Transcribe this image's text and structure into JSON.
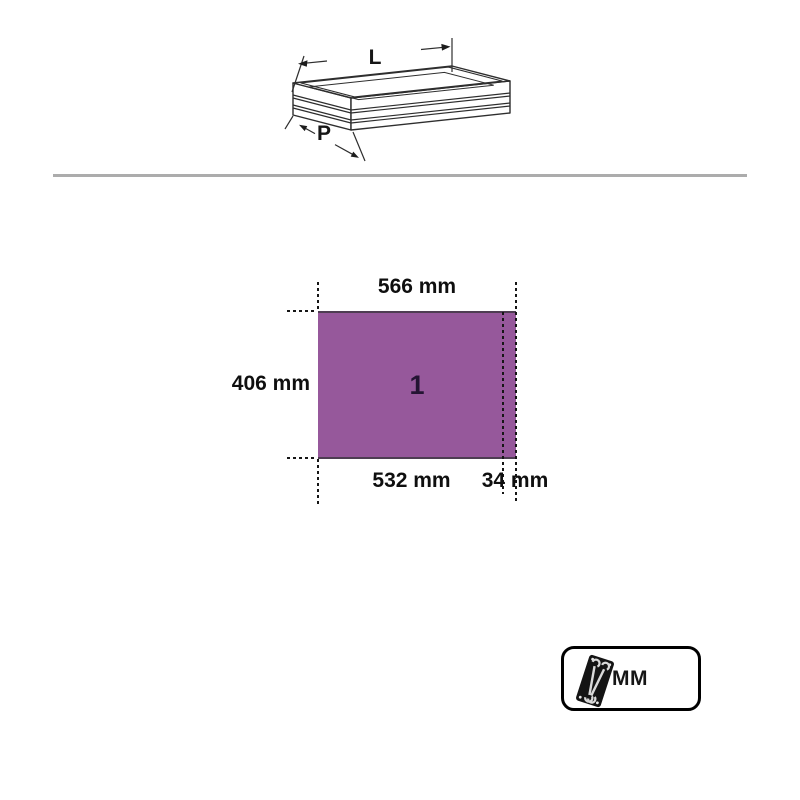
{
  "figure": {
    "length_label": "L",
    "depth_label": "P"
  },
  "module_diagram": {
    "module": {
      "number": "1",
      "fill_color": "#96589B",
      "edge_color": "#4E3D52"
    },
    "dimensions": {
      "top_width": "566 mm",
      "left_height": "406 mm",
      "bottom_main_width": "532 mm",
      "bottom_edge_width": "34 mm"
    }
  },
  "unit_badge": {
    "label": "MM"
  },
  "colors": {
    "divider": "#ACACAC",
    "dash_line": "#161616",
    "dimension_text": "#0F0F0F"
  }
}
